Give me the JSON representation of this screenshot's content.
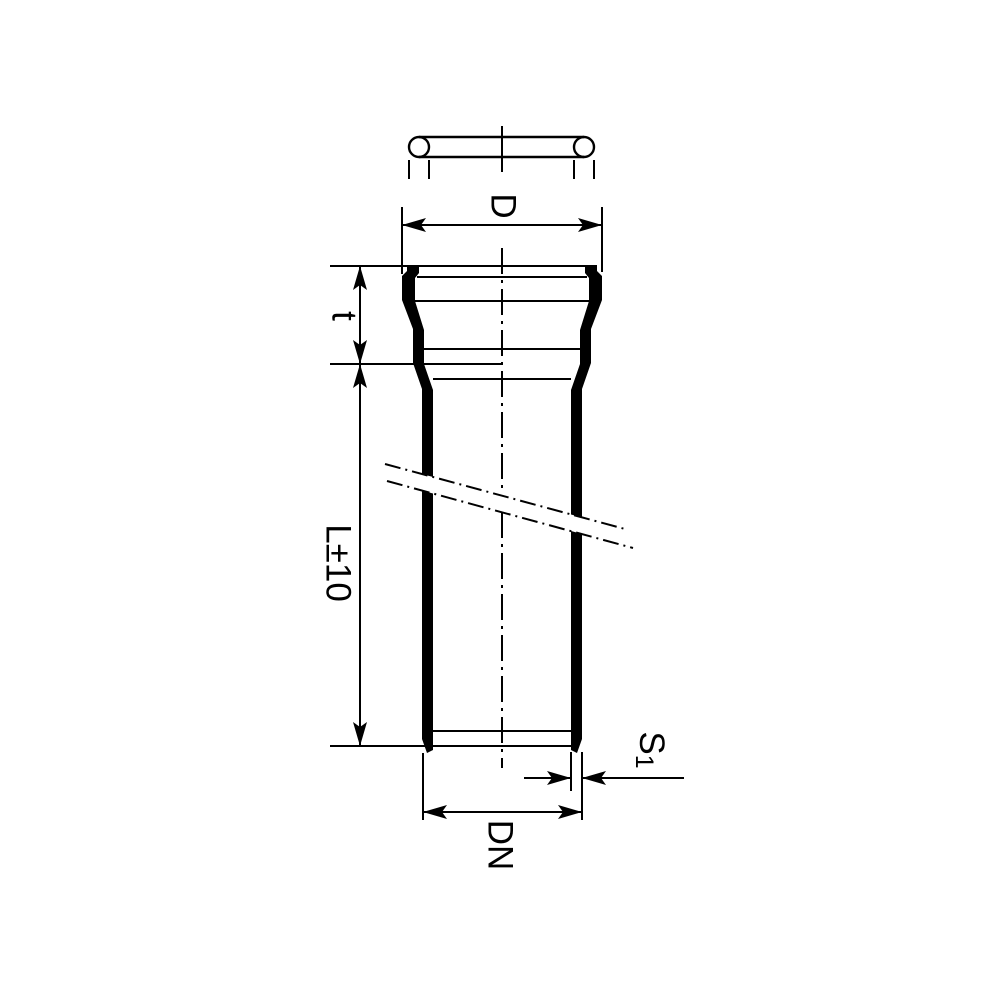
{
  "drawing": {
    "colors": {
      "line": "#000000",
      "background": "#ffffff"
    },
    "labels": {
      "socket_outer_diameter": "D",
      "socket_depth": "t",
      "pipe_length": "L±10",
      "wall_thickness_base": "S",
      "wall_thickness_subscript": "1",
      "nominal_diameter": "DN"
    }
  }
}
